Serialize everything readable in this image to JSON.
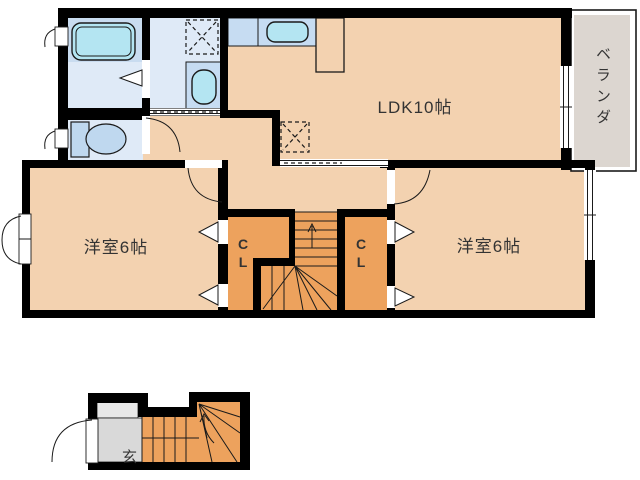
{
  "title": "2F/1F apartment floor plan",
  "labels": {
    "ldk": "LDK10帖",
    "west_room_left": "洋室6帖",
    "west_room_right": "洋室6帖",
    "closet_left_c": "C",
    "closet_left_l": "L",
    "closet_right_c": "C",
    "closet_right_l": "L",
    "veranda": "ベランダ",
    "entrance": "玄"
  },
  "icons": {
    "bathtub": "bathtub-icon",
    "toilet": "toilet-icon",
    "sink": "sink-icon",
    "kitchen_sink": "kitchen-sink-icon",
    "washer_pan": "washing-machine-pan-icon",
    "stairs_up_arrow": "stairs-direction-arrow-icon"
  },
  "colors": {
    "wall": "#000000",
    "line": "#1a1a1a",
    "floor": "#f3d2b0",
    "closet": "#eda25d",
    "water_light": "#dfeaf7",
    "water_mid": "#c9dcf0",
    "counter": "#c6dcf2",
    "fixture": "#b4e5f2",
    "fixture2": "#bfd8ef",
    "veranda": "#dcd6d0",
    "entrance": "#d9d9d9",
    "entrance_step": "#e8e8e8",
    "label": "#333333"
  }
}
